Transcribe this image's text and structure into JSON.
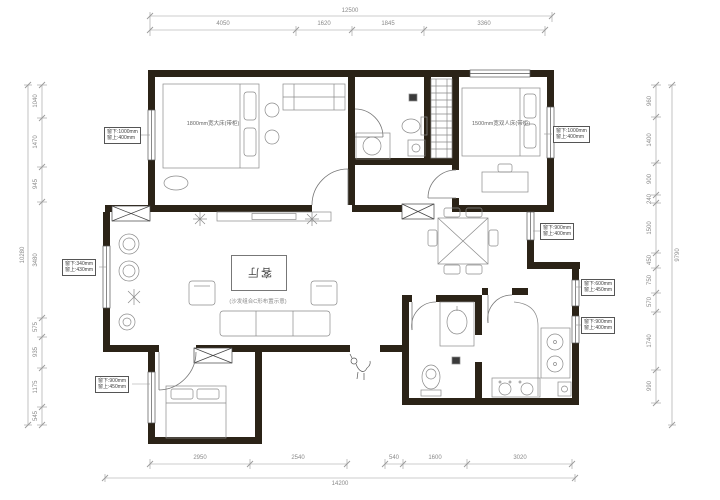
{
  "drawing": {
    "rooms": {
      "master_bed_label": "1800mm宽大床(带柜)",
      "second_bed_label": "1500mm宽双人床(带柜)",
      "living_label": "客厅",
      "living_note": "(沙发组合C形布置示意)"
    },
    "window_notes": [
      {
        "line1": "窗下:1000mm",
        "line2": "窗上:400mm"
      },
      {
        "line1": "窗下:340mm",
        "line2": "窗上:430mm"
      },
      {
        "line1": "窗下:900mm",
        "line2": "窗上:450mm"
      },
      {
        "line1": "窗下:1000mm",
        "line2": "窗上:400mm"
      },
      {
        "line1": "窗下:900mm",
        "line2": "窗上:400mm"
      },
      {
        "line1": "窗下:600mm",
        "line2": "窗上:450mm"
      },
      {
        "line1": "窗下:900mm",
        "line2": "窗上:400mm"
      }
    ],
    "dimensions": {
      "top": {
        "total": "12500",
        "segments": [
          "4050",
          "1620",
          "1845",
          "3360"
        ]
      },
      "bottom": {
        "total": "14200",
        "segments": [
          "2950",
          "2540",
          "540",
          "1600",
          "3020"
        ]
      },
      "left": {
        "total": "10280",
        "segments": [
          "1040",
          "1470",
          "945",
          "3480",
          "575",
          "935",
          "1175",
          "545"
        ]
      },
      "right": {
        "total": "9790",
        "segments": [
          "960",
          "1400",
          "900",
          "240",
          "1500",
          "450",
          "750",
          "570",
          "1740",
          "990"
        ]
      }
    }
  }
}
